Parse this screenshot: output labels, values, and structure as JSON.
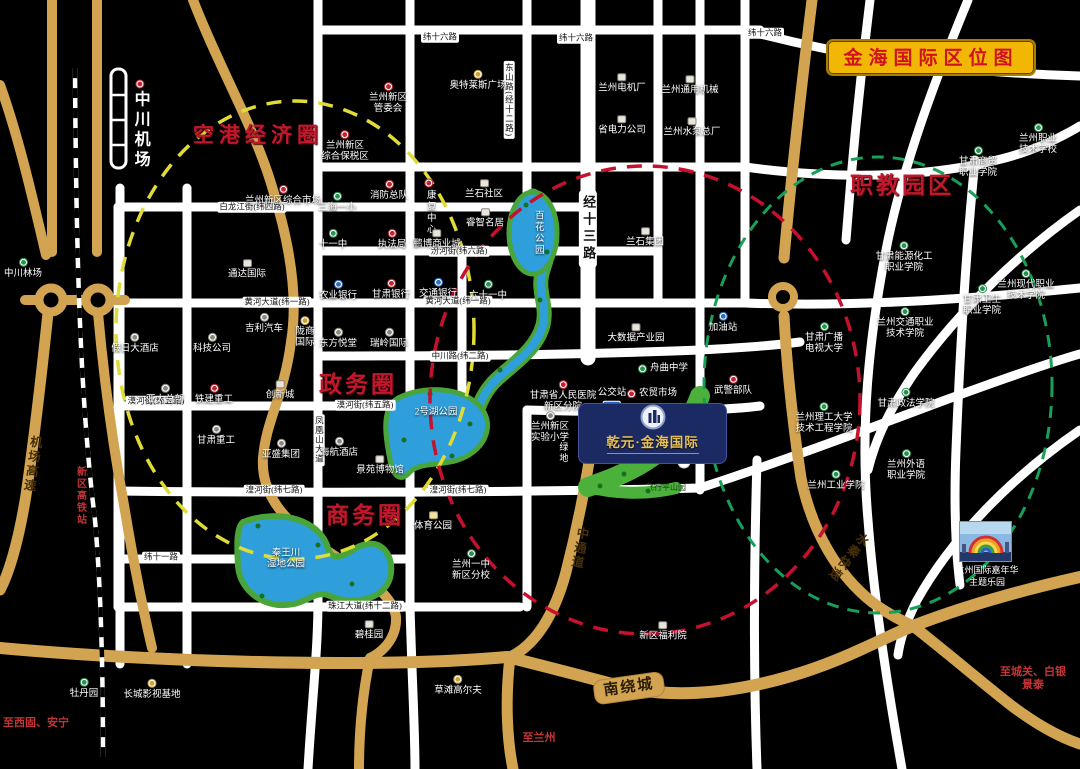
{
  "title": "金海国际区位图",
  "project": {
    "name": "乾元·金海国际"
  },
  "photo": {
    "caption1": "兰州国际嘉年华",
    "caption2": "主题乐园"
  },
  "colors": {
    "background": "#000000",
    "white_road": "#ffffff",
    "gold_road": "#d2a452",
    "title_bg": "#f2b704",
    "title_text": "#d0121f",
    "zone_red": "#c2182e",
    "lake_blue": "#2f9fdc",
    "park_green": "#4cb13a",
    "project_navy": "#1c2a63",
    "project_gold_text": "#e6c05a",
    "note_red": "#c43535",
    "circle_yellow": "#e0dc34",
    "circle_red": "#c5102e",
    "circle_green": "#18a058"
  },
  "icons": [
    "red-dot-icon",
    "green-dot-icon",
    "blue-dot-icon",
    "yellow-dot-icon",
    "white-dot-icon",
    "building-square-icon",
    "park-square-icon",
    "bus-sign-icon",
    "runway-icon",
    "railway-line",
    "photo-thumbnail",
    "project-emblem-icon"
  ],
  "zones": [
    {
      "label": "空港经济圈",
      "x": 258,
      "y": 134,
      "size": 21,
      "ls": 5
    },
    {
      "label": "政务圈",
      "x": 358,
      "y": 382,
      "size": 23,
      "ls": 3
    },
    {
      "label": "商务圈",
      "x": 365,
      "y": 513,
      "size": 23,
      "ls": 3
    },
    {
      "label": "职教园区",
      "x": 902,
      "y": 183,
      "size": 23,
      "ls": 3
    }
  ],
  "zone_circles": [
    {
      "name": "airport-economic-circle",
      "color": "#e0dc34",
      "cx": 295,
      "cy": 330,
      "rx": 179,
      "ry": 229,
      "dash": "15 11",
      "w": 3.5
    },
    {
      "name": "government-business-circle",
      "color": "#c5102e",
      "cx": 645,
      "cy": 400,
      "rx": 215,
      "ry": 234,
      "dash": "15 11",
      "w": 3.5
    },
    {
      "name": "vocational-education-circle",
      "color": "#18a058",
      "cx": 878,
      "cy": 385,
      "rx": 174,
      "ry": 228,
      "dash": "12 9",
      "w": 3
    }
  ],
  "road_labels": [
    {
      "t": "纬十六路",
      "x": 440,
      "y": 37,
      "k": "w"
    },
    {
      "t": "纬十六路",
      "x": 576,
      "y": 38,
      "k": "w"
    },
    {
      "t": "纬十六路",
      "x": 765,
      "y": 33,
      "k": "w"
    },
    {
      "t": "白龙江街(纬四路)",
      "x": 252,
      "y": 207,
      "k": "w"
    },
    {
      "t": "汾河街(纬六路)",
      "x": 459,
      "y": 251,
      "k": "w"
    },
    {
      "t": "黄河大道(纬一路)",
      "x": 277,
      "y": 302,
      "k": "w"
    },
    {
      "t": "黄河大道(纬一路)",
      "x": 458,
      "y": 301,
      "k": "w"
    },
    {
      "t": "中川路(纬二路)",
      "x": 460,
      "y": 356,
      "k": "w"
    },
    {
      "t": "漠河街(纬五路)",
      "x": 156,
      "y": 401,
      "k": "w"
    },
    {
      "t": "漠河街(纬五路)",
      "x": 365,
      "y": 405,
      "k": "w"
    },
    {
      "t": "纬五大道",
      "x": 648,
      "y": 410,
      "k": "w"
    },
    {
      "t": "湟河街(纬七路)",
      "x": 274,
      "y": 490,
      "k": "w"
    },
    {
      "t": "湟河街(纬七路)",
      "x": 458,
      "y": 490,
      "k": "w"
    },
    {
      "t": "纬十一路",
      "x": 161,
      "y": 557,
      "k": "w"
    },
    {
      "t": "珠江大道(纬十二路)",
      "x": 365,
      "y": 606,
      "k": "w"
    },
    {
      "t": "东山路(经十二路)",
      "x": 509,
      "y": 100,
      "k": "wv"
    },
    {
      "t": "凤凰山大道",
      "x": 319,
      "y": 440,
      "k": "wv"
    },
    {
      "t": "经十三路",
      "x": 588,
      "y": 229,
      "k": "j13"
    },
    {
      "t": "机场高速",
      "x": 31,
      "y": 464,
      "k": "gv",
      "rot": 8
    },
    {
      "t": "中通道",
      "x": 578,
      "y": 548,
      "k": "gv",
      "rot": 10
    },
    {
      "t": "水秦快速",
      "x": 847,
      "y": 556,
      "k": "gv",
      "rot": 38
    },
    {
      "t": "南绕城",
      "x": 629,
      "y": 688,
      "k": "gbox",
      "rot": -8
    }
  ],
  "notes": [
    {
      "t": "新区高铁站",
      "x": 80,
      "y": 496,
      "o": "v"
    },
    {
      "t": "至西固、安宁",
      "x": 36,
      "y": 722,
      "o": "h"
    },
    {
      "t": "至兰州",
      "x": 539,
      "y": 737,
      "o": "h"
    },
    {
      "t": "至城关、白银",
      "x": 1033,
      "y": 671,
      "o": "h"
    },
    {
      "t": "景泰",
      "x": 1033,
      "y": 684,
      "o": "h"
    }
  ],
  "pois": [
    {
      "n": "中川机场",
      "x": 140,
      "y": 125,
      "t": "rd",
      "o": "v",
      "cls": "airport"
    },
    {
      "n": "兰州新区|管委会",
      "x": 388,
      "y": 99,
      "t": "rd"
    },
    {
      "n": "奥特莱斯广场",
      "x": 478,
      "y": 81,
      "t": "yd"
    },
    {
      "n": "兰州新区|综合保税区",
      "x": 345,
      "y": 147,
      "t": "rd"
    },
    {
      "n": "兰州电机厂",
      "x": 622,
      "y": 84,
      "t": "sq"
    },
    {
      "n": "兰州通用机械",
      "x": 690,
      "y": 86,
      "t": "sq"
    },
    {
      "n": "省电力公司",
      "x": 622,
      "y": 126,
      "t": "sq"
    },
    {
      "n": "兰州水泵总厂",
      "x": 692,
      "y": 128,
      "t": "sq"
    },
    {
      "n": "兰州职业|技术学校",
      "x": 1038,
      "y": 140,
      "t": "gd"
    },
    {
      "n": "甘肃商贸|职业学院",
      "x": 978,
      "y": 163,
      "t": "gd"
    },
    {
      "n": "兰州新区综合市场",
      "x": 283,
      "y": 196,
      "t": "rd"
    },
    {
      "n": "三海一小",
      "x": 337,
      "y": 203,
      "t": "gd"
    },
    {
      "n": "消防总队",
      "x": 389,
      "y": 191,
      "t": "rd"
    },
    {
      "n": "康复中心",
      "x": 429,
      "y": 207,
      "t": "rd",
      "o": "v"
    },
    {
      "n": "兰石社区",
      "x": 484,
      "y": 190,
      "t": "sq"
    },
    {
      "n": "睿智名居",
      "x": 485,
      "y": 219,
      "t": "sq"
    },
    {
      "n": "十一中",
      "x": 333,
      "y": 240,
      "t": "gd"
    },
    {
      "n": "执法局",
      "x": 392,
      "y": 240,
      "t": "rd"
    },
    {
      "n": "鹏博商业城",
      "x": 437,
      "y": 240,
      "t": "sq"
    },
    {
      "n": "兰石集团",
      "x": 645,
      "y": 238,
      "t": "sq"
    },
    {
      "n": "中川林场",
      "x": 23,
      "y": 269,
      "t": "gd"
    },
    {
      "n": "通达国际",
      "x": 247,
      "y": 270,
      "t": "sq"
    },
    {
      "n": "甘肃能源化工|职业学院",
      "x": 904,
      "y": 258,
      "t": "gd"
    },
    {
      "n": "兰州现代职业|技术学院",
      "x": 1026,
      "y": 286,
      "t": "gd"
    },
    {
      "n": "甘肃卫生|职业学院",
      "x": 982,
      "y": 301,
      "t": "gd"
    },
    {
      "n": "兰州交通职业|技术学院",
      "x": 905,
      "y": 324,
      "t": "gd"
    },
    {
      "n": "农业银行",
      "x": 338,
      "y": 291,
      "t": "bd"
    },
    {
      "n": "甘肃银行",
      "x": 391,
      "y": 290,
      "t": "rd"
    },
    {
      "n": "交通银行",
      "x": 438,
      "y": 289,
      "t": "bd"
    },
    {
      "n": "六十一中",
      "x": 488,
      "y": 291,
      "t": "gd"
    },
    {
      "n": "假日大酒店",
      "x": 135,
      "y": 344,
      "t": "wd"
    },
    {
      "n": "科技公司",
      "x": 212,
      "y": 344,
      "t": "wd"
    },
    {
      "n": "吉利汽车",
      "x": 264,
      "y": 324,
      "t": "wd"
    },
    {
      "n": "陇商|国际",
      "x": 305,
      "y": 333,
      "t": "yd"
    },
    {
      "n": "东方悦堂",
      "x": 338,
      "y": 339,
      "t": "wd"
    },
    {
      "n": "瑞岭国际",
      "x": 389,
      "y": 339,
      "t": "wd"
    },
    {
      "n": "亚太总部",
      "x": 165,
      "y": 395,
      "t": "wd"
    },
    {
      "n": "铁建重工",
      "x": 214,
      "y": 395,
      "t": "rd"
    },
    {
      "n": "创新城",
      "x": 280,
      "y": 391,
      "t": "sq"
    },
    {
      "n": "甘肃广播|电视大学",
      "x": 824,
      "y": 339,
      "t": "gd"
    },
    {
      "n": "加油站",
      "x": 723,
      "y": 323,
      "t": "bd"
    },
    {
      "n": "大数据产业园",
      "x": 636,
      "y": 334,
      "t": "sq"
    },
    {
      "n": "舟曲中学",
      "x": 663,
      "y": 369,
      "t": "gd",
      "ip": "left"
    },
    {
      "n": "农贸市场",
      "x": 652,
      "y": 394,
      "t": "rd",
      "ip": "left"
    },
    {
      "n": "武警部队",
      "x": 733,
      "y": 386,
      "t": "rd"
    },
    {
      "n": "甘肃省人民医院|新区分院",
      "x": 563,
      "y": 397,
      "t": "rd"
    },
    {
      "n": "公交站",
      "x": 612,
      "y": 399,
      "t": "bus"
    },
    {
      "n": "兰州新区|实验小学",
      "x": 550,
      "y": 428,
      "t": "wd"
    },
    {
      "n": "甘肃重工",
      "x": 216,
      "y": 436,
      "t": "wd"
    },
    {
      "n": "亚盛集团",
      "x": 281,
      "y": 450,
      "t": "wd"
    },
    {
      "n": "海航酒店",
      "x": 339,
      "y": 448,
      "t": "wd"
    },
    {
      "n": "景苑博物馆",
      "x": 380,
      "y": 466,
      "t": "sq"
    },
    {
      "n": "甘肃政法学院",
      "x": 906,
      "y": 399,
      "t": "gd"
    },
    {
      "n": "兰州理工大学|技术工程学院",
      "x": 824,
      "y": 419,
      "t": "gd"
    },
    {
      "n": "绿地",
      "x": 563,
      "y": 453,
      "t": "none",
      "o": "v",
      "sz": 9
    },
    {
      "n": "兰州外语|职业学院",
      "x": 906,
      "y": 466,
      "t": "gd"
    },
    {
      "n": "兰州工业学院",
      "x": 836,
      "y": 481,
      "t": "gd"
    },
    {
      "n": "体育公园",
      "x": 433,
      "y": 522,
      "t": "ysq"
    },
    {
      "n": "兰州一中|新区分校",
      "x": 471,
      "y": 566,
      "t": "gd"
    },
    {
      "n": "碧桂园",
      "x": 369,
      "y": 631,
      "t": "sq"
    },
    {
      "n": "新区福利院",
      "x": 663,
      "y": 632,
      "t": "sq"
    },
    {
      "n": "草滩高尔夫",
      "x": 458,
      "y": 686,
      "t": "yd"
    },
    {
      "n": "长城影视基地",
      "x": 152,
      "y": 690,
      "t": "yd"
    },
    {
      "n": "牡丹园",
      "x": 84,
      "y": 689,
      "t": "gd"
    },
    {
      "n": "秦王川|湿地公园",
      "x": 286,
      "y": 560,
      "t": "none"
    },
    {
      "n": "百花公园",
      "x": 537,
      "y": 233,
      "t": "none",
      "o": "v"
    },
    {
      "n": "2号湖公园",
      "x": 436,
      "y": 413,
      "t": "none"
    },
    {
      "n": "飞行平山园",
      "x": 666,
      "y": 488,
      "t": "none",
      "sz": 8,
      "c": "#14401a"
    }
  ]
}
